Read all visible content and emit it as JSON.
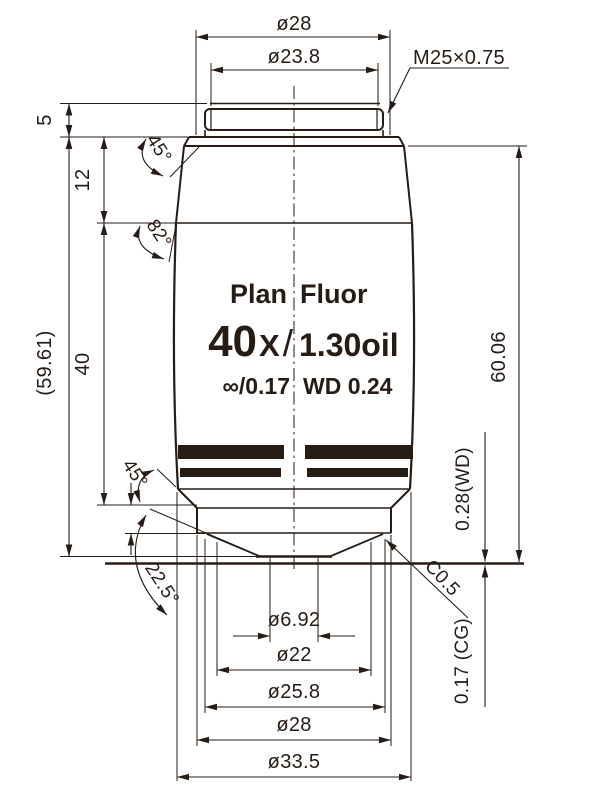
{
  "drawing": {
    "ink_color": "#261b15",
    "background": "#ffffff",
    "type": "microscope-objective-dimension-drawing"
  },
  "labels": {
    "top": {
      "outer_diameter": "ø28",
      "thread_diameter": "ø23.8",
      "thread_spec": "M25×0.75"
    },
    "left": {
      "thread_length": "5",
      "shoulder_length": "12",
      "barrel_length": "40",
      "overall_ref": "(59.61)"
    },
    "right": {
      "parfocal": "60.06",
      "working_distance": "0.28(WD)",
      "cover_glass": "0.17 (CG)",
      "chamfer": "C0.5"
    },
    "angles": {
      "top_chamfer": "45°",
      "shoulder_angle": "82°",
      "bottom_chamfer": "45°",
      "nose_cone": "22.5°"
    },
    "bottom": {
      "front_lens": "ø6.92",
      "cone_base": "ø22",
      "nose_rim": "ø25.8",
      "nose_diameter": "ø28",
      "max_diameter": "ø33.5"
    },
    "body": {
      "series_left": "Plan",
      "series_right": "Fluor",
      "magnification": "40",
      "mag_x": "X",
      "slash": "/",
      "numerical_aperture": "1.30oil",
      "tube_cover": "∞/0.17",
      "working_distance_label": "WD  0.24"
    }
  }
}
